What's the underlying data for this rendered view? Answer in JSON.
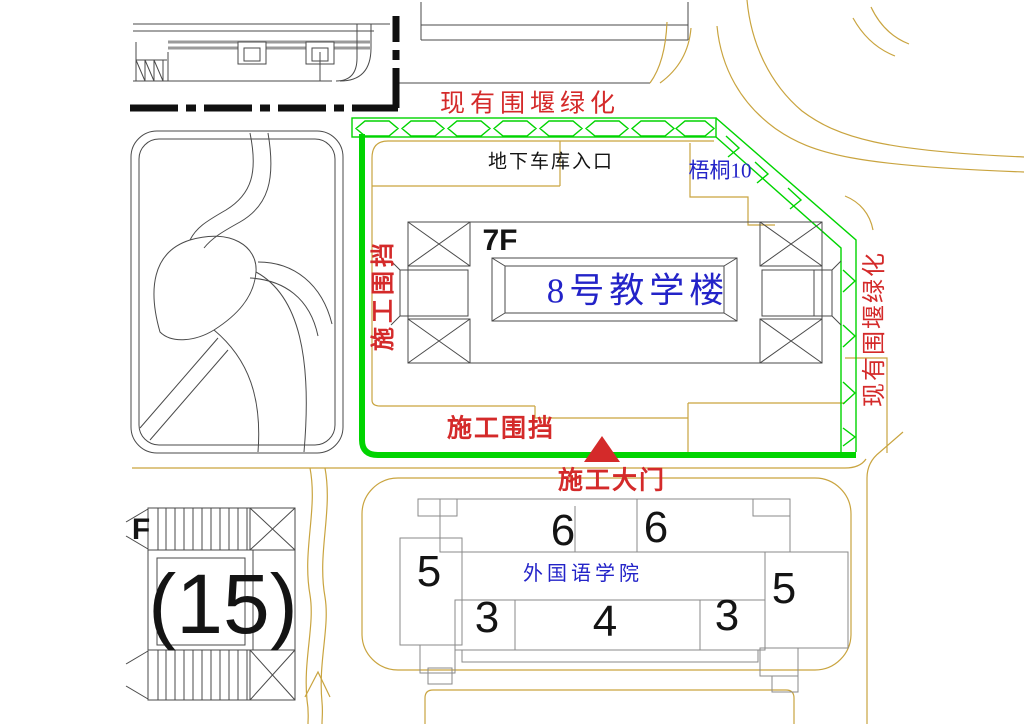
{
  "drawing": {
    "annotations": {
      "hedge_top_label": "现有围堰绿化",
      "garage_entrance_label": "地下车库入口",
      "tree_label": "梧桐10",
      "fence_left_label": "施工围挡",
      "floor_label": "7F",
      "building8_label": "8号教学楼",
      "hedge_right_label": "现有围堰绿化",
      "fence_bottom_label": "施工围挡",
      "gate_label": "施工大门",
      "college_label": "外国语学院",
      "building15_label": "(15)",
      "building_f_label": "F"
    },
    "unit_numbers": [
      "6",
      "6",
      "5",
      "5",
      "3",
      "4",
      "3"
    ],
    "icons": {
      "gate_marker": "red-triangle-up",
      "hedge_pattern": "hexagon-chain",
      "fence_line": "thick-green-line",
      "site_boundary": "thick-black-dashed-line"
    },
    "colors": {
      "fence_green": "#00d400",
      "annotation_red": "#d42a2a",
      "label_blue": "#2323c8",
      "road_tan": "#c9a43f",
      "line_gray": "#4a4a4a",
      "boundary_black": "#101010"
    }
  }
}
